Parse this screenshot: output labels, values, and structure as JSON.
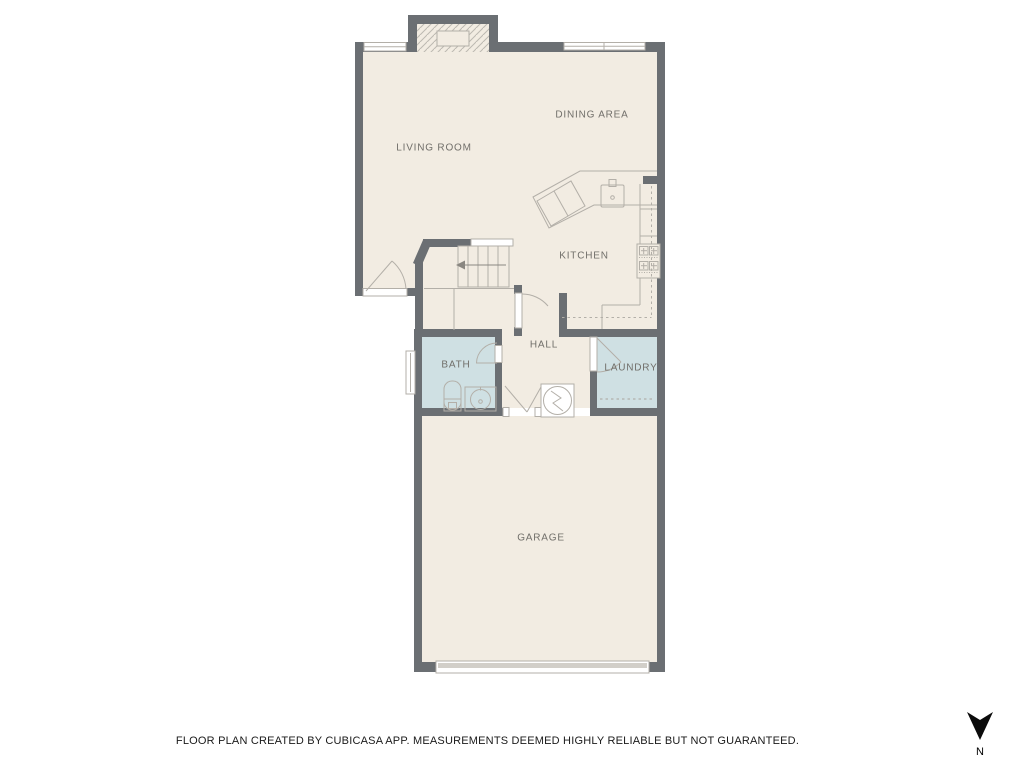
{
  "plan": {
    "rooms": [
      {
        "id": "living-room",
        "label": "LIVING ROOM"
      },
      {
        "id": "dining-area",
        "label": "DINING AREA"
      },
      {
        "id": "kitchen",
        "label": "KITCHEN"
      },
      {
        "id": "hall",
        "label": "HALL"
      },
      {
        "id": "bath",
        "label": "BATH"
      },
      {
        "id": "laundry",
        "label": "LAUNDRY"
      },
      {
        "id": "garage",
        "label": "GARAGE"
      }
    ],
    "colors": {
      "wall": "#6b6f73",
      "floor": "#f2ece2",
      "wet_room": "#cfe0e3",
      "fixture_line": "#b3afa8",
      "room_label": "#716f6a"
    },
    "fixtures": [
      "fireplace",
      "stairs",
      "stair-direction-arrow",
      "kitchen-counter",
      "kitchen-sink",
      "stove",
      "toilet",
      "bathroom-sink",
      "water-heater",
      "garage-door",
      "windows",
      "doors"
    ]
  },
  "footer": {
    "disclaimer": "FLOOR PLAN CREATED BY CUBICASA APP. MEASUREMENTS DEEMED HIGHLY RELIABLE BUT NOT GUARANTEED."
  },
  "compass": {
    "label": "N",
    "direction": "down"
  }
}
